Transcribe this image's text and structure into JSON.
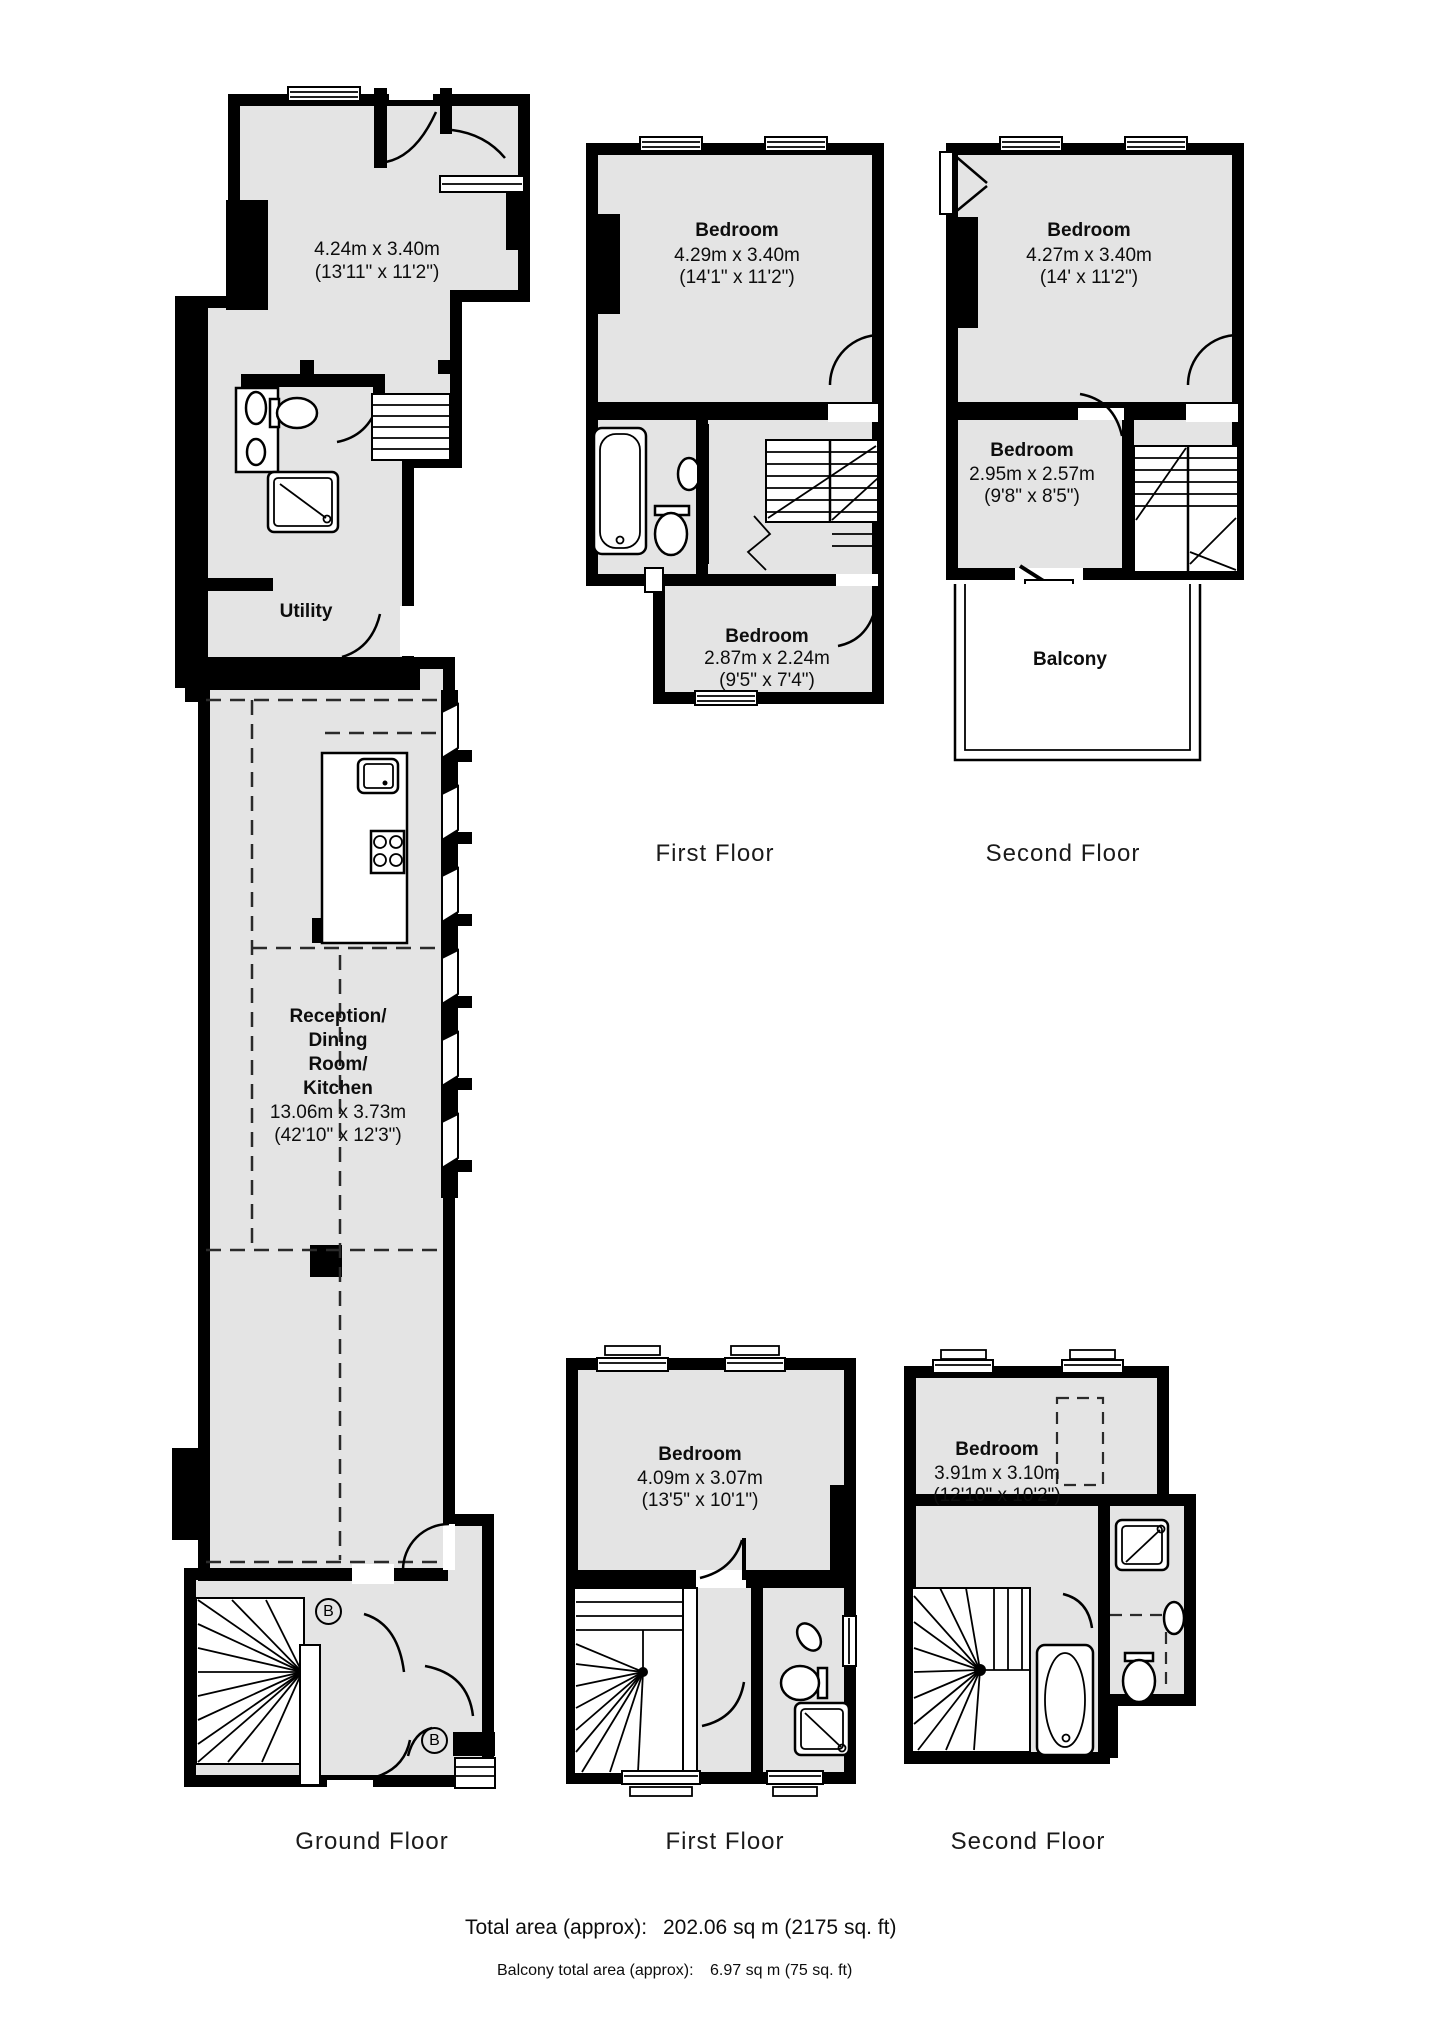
{
  "plans": {
    "ground_floor": {
      "floor_label": "Ground Floor",
      "front_room": {
        "dims_m": "4.24m x 3.40m",
        "dims_ft": "(13'11\" x 11'2\")"
      },
      "utility": {
        "name": "Utility"
      },
      "reception": {
        "name_lines": [
          "Reception/",
          "Dining",
          "Room/",
          "Kitchen"
        ],
        "dims_m": "13.06m x 3.73m",
        "dims_ft": "(42'10\" x 12'3\")"
      },
      "boiler_symbol": "B"
    },
    "first_floor_upper": {
      "floor_label": "First Floor",
      "bedroom_main": {
        "name": "Bedroom",
        "dims_m": "4.29m x 3.40m",
        "dims_ft": "(14'1\" x 11'2\")"
      },
      "bedroom_small": {
        "name": "Bedroom",
        "dims_m": "2.87m x 2.24m",
        "dims_ft": "(9'5\" x 7'4\")"
      }
    },
    "second_floor_upper": {
      "floor_label": "Second Floor",
      "bedroom_main": {
        "name": "Bedroom",
        "dims_m": "4.27m x 3.40m",
        "dims_ft": "(14' x 11'2\")"
      },
      "bedroom_small": {
        "name": "Bedroom",
        "dims_m": "2.95m x 2.57m",
        "dims_ft": "(9'8\" x 8'5\")"
      },
      "balcony": {
        "name": "Balcony"
      }
    },
    "first_floor_lower": {
      "floor_label": "First Floor",
      "bedroom": {
        "name": "Bedroom",
        "dims_m": "4.09m x 3.07m",
        "dims_ft": "(13'5\" x 10'1\")"
      }
    },
    "second_floor_lower": {
      "floor_label": "Second Floor",
      "bedroom": {
        "name": "Bedroom",
        "dims_m": "3.91m x 3.10m",
        "dims_ft": "(12'10\" x 10'2\")"
      }
    }
  },
  "totals": {
    "total_label": "Total area (approx):",
    "total_value": "202.06 sq m (2175 sq. ft)",
    "balcony_label": "Balcony total area (approx):",
    "balcony_value": "6.97 sq m (75 sq. ft)"
  },
  "colors": {
    "room_fill": "#e4e4e4",
    "wall": "#000000",
    "background": "#ffffff"
  }
}
